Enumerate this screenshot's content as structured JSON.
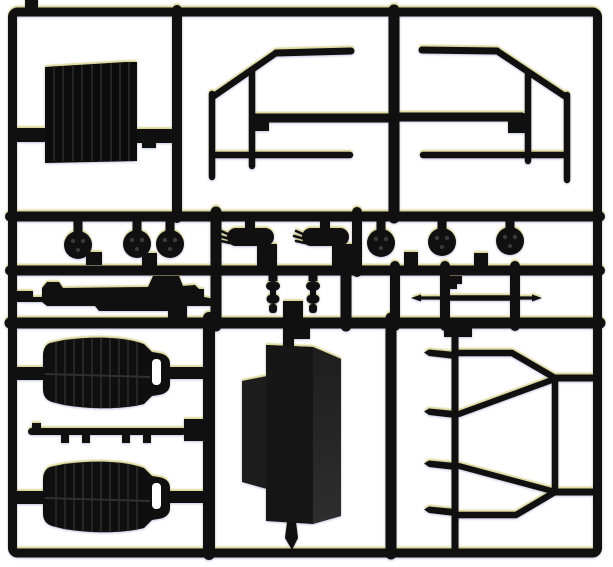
{
  "photo": {
    "subject": "Black plastic model kit parts sprue",
    "alt_text": "Rectangular black sprue frame holding unpainted black model car parts: a ribbed panel, two door window frames, six round wheel hubs, two mufflers, two shock absorbers, an axle rod, a chassis rail, two bucket seats, a fuel tank box and a rear cage frame",
    "background_color": "#ffffff"
  },
  "palette": {
    "plastic": "#101010",
    "plastic_soft": "#1a1a1a",
    "box_front": "#161616",
    "box_side": "#272727",
    "box_flap": "#1d1d1d",
    "rib_highlight": "#2c2c2c",
    "background": "#ffffff",
    "fringe_warm": "#cec446",
    "fringe_cool": "#342c96"
  },
  "parts": [
    {
      "name": "ribbed-panel",
      "count": 1
    },
    {
      "name": "window-frame-left",
      "count": 1
    },
    {
      "name": "window-frame-right",
      "count": 1
    },
    {
      "name": "wheel-hub",
      "count": 6
    },
    {
      "name": "muffler",
      "count": 2
    },
    {
      "name": "shock-absorber",
      "count": 2
    },
    {
      "name": "axle-rod",
      "count": 1
    },
    {
      "name": "chassis-rail",
      "count": 1
    },
    {
      "name": "bucket-seat",
      "count": 2
    },
    {
      "name": "side-sill-rod",
      "count": 1
    },
    {
      "name": "fuel-tank-box",
      "count": 1
    },
    {
      "name": "rear-cage-frame",
      "count": 1
    }
  ]
}
